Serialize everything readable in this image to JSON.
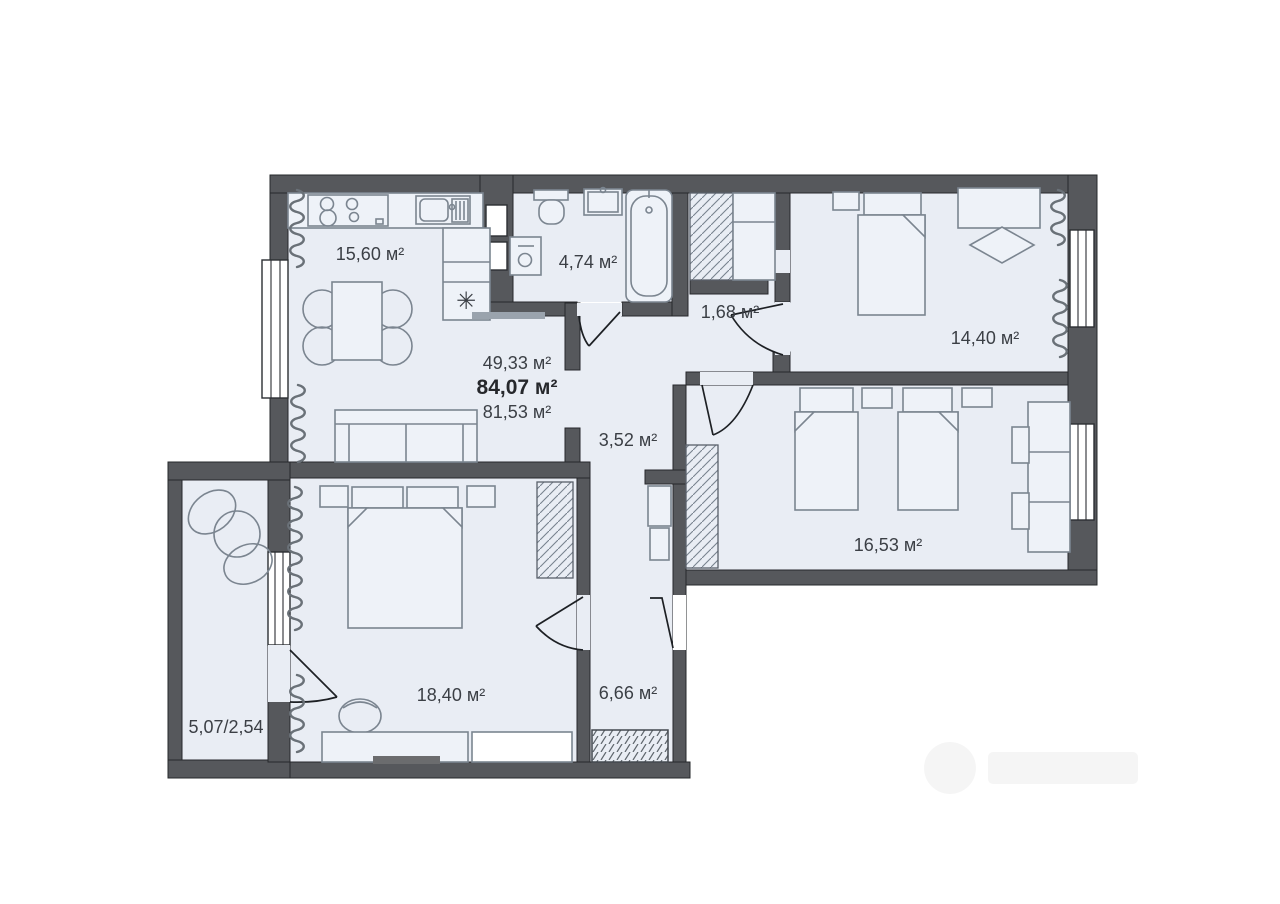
{
  "plan": {
    "type": "apartment-floor-plan",
    "colors": {
      "wall": "#56585c",
      "room_fill": "#e9edf4",
      "furniture": "#7b8590",
      "label": "#3b3f45"
    },
    "labels": {
      "kitchen_living": "15,60 м²",
      "bathroom": "4,74 м²",
      "hall_small": "1,68 м²",
      "bedroom_main": "14,40 м²",
      "corridor": "3,52 м²",
      "room_second": "16,53 м²",
      "bedroom_lower": "18,40 м²",
      "hall_entry": "6,66 м²",
      "balcony": "5,07/2,54"
    },
    "totals": {
      "living_area": "49,33 м²",
      "total_area": "84,07 м²",
      "reduced_area": "81,53 м²"
    },
    "symbols": {
      "fridge": "✳"
    }
  }
}
